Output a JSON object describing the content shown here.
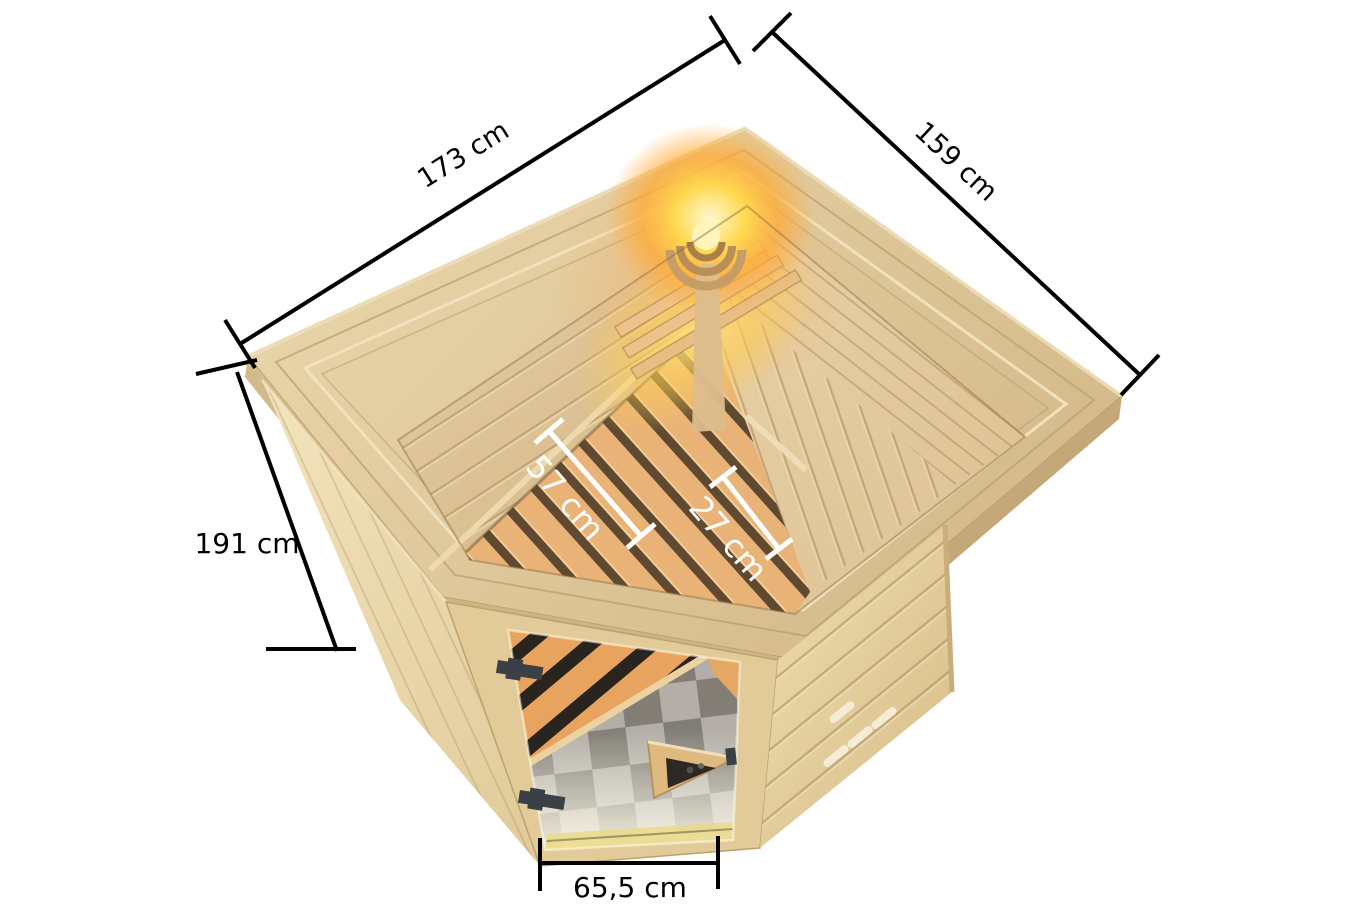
{
  "scene": {
    "type": "product-dimension-diagram",
    "subject": "corner sauna with glass door seen from above"
  },
  "measurements": {
    "top_left_edge": "173 cm",
    "top_right_edge": "159 cm",
    "left_edge": "191 cm",
    "bench_depth": "57 cm",
    "bench_step_depth": "27 cm",
    "door_width": "65,5 cm"
  },
  "colors": {
    "background": "#ffffff",
    "dimension_line": "#000000",
    "interior_dimension_line": "#ffffff",
    "roof_wood": "#e2cda1",
    "trim_wood": "#cdb484",
    "front_wall_wood": "#eedcb2",
    "bench_slat": "#e9b277",
    "bench_gap": "#5f4a31",
    "lamp_glow": "#ffd84f",
    "floor_tile_dark": "#827e76",
    "floor_tile_light": "#b3afa8",
    "door_hinge": "#3a4046"
  }
}
